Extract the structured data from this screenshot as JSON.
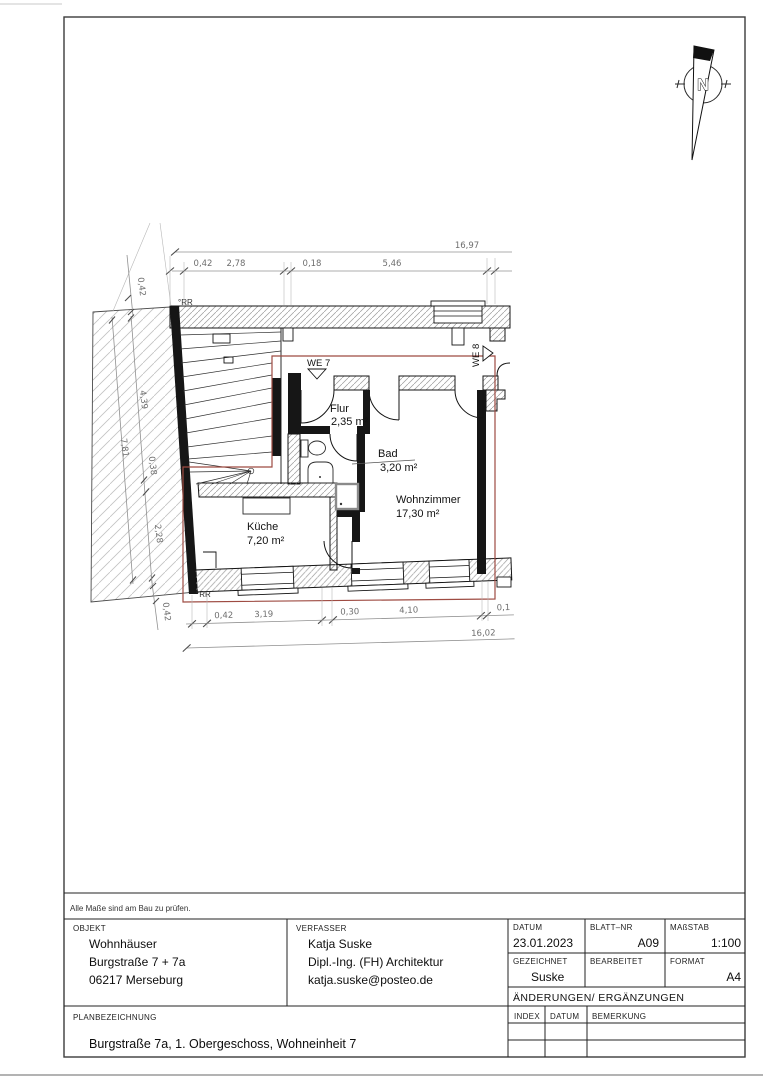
{
  "sheet": {
    "note": "Alle Maße sind am Bau zu prüfen.",
    "north_label": "N"
  },
  "plan": {
    "rooms": [
      {
        "name": "Flur",
        "area": "2,35 m²"
      },
      {
        "name": "Bad",
        "area": "3,20 m²"
      },
      {
        "name": "Wohnzimmer",
        "area": "17,30 m²"
      },
      {
        "name": "Küche",
        "area": "7,20 m²"
      }
    ],
    "units": {
      "we7": "WE 7",
      "we8": "WE 8"
    },
    "rr_top": "°RR",
    "rr_bottom": "°RR",
    "dims_top": {
      "total": "16,97",
      "seg": [
        "0,42",
        "2,78",
        "0,18",
        "5,46"
      ]
    },
    "dims_bottom": {
      "total": "16,02",
      "seg": [
        "0,42",
        "3,19",
        "0,30",
        "4,10",
        "0,1"
      ]
    },
    "dims_left": {
      "total": "7,81",
      "top": "0,42",
      "seg": [
        "4,39",
        "0,38",
        "2,28"
      ],
      "bottom": "0,42"
    }
  },
  "title_block": {
    "objekt": {
      "label": "OBJEKT",
      "lines": [
        "Wohnhäuser",
        "Burgstraße 7 + 7a",
        "06217 Merseburg"
      ]
    },
    "verfasser": {
      "label": "VERFASSER",
      "lines": [
        "Katja Suske",
        "Dipl.-Ing. (FH) Architektur",
        "katja.suske@posteo.de"
      ]
    },
    "datum": {
      "label": "DATUM",
      "value": "23.01.2023"
    },
    "blatt_nr": {
      "label": "BLATT–NR",
      "value": "A09"
    },
    "massstab": {
      "label": "MAßSTAB",
      "value": "1:100"
    },
    "gezeichnet": {
      "label": "GEZEICHNET",
      "value": "Suske"
    },
    "bearbeitet": {
      "label": "BEARBEITET",
      "value": ""
    },
    "format": {
      "label": "FORMAT",
      "value": "A4"
    },
    "aenderungen": {
      "label": "ÄNDERUNGEN/  ERGÄNZUNGEN"
    },
    "index_header": {
      "index": "INDEX",
      "datum": "DATUM",
      "bemerkung": "BEMERKUNG"
    },
    "planbezeichnung": {
      "label": "PLANBEZEICHNUNG",
      "value": "Burgstraße 7a, 1. Obergeschoss, Wohneinheit 7"
    }
  }
}
